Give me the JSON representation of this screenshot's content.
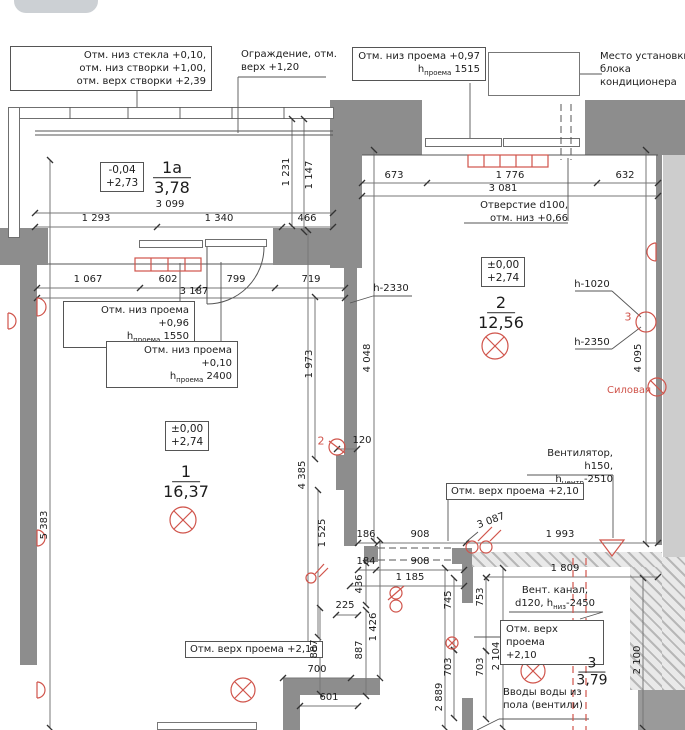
{
  "colors": {
    "wall_gray": "#8d8d8d",
    "outer_gray": "#cdcdcd",
    "accent_red": "#d0544b",
    "line_dark": "#333333"
  },
  "rooms": {
    "balcony": {
      "num": "1а",
      "area": "3,78",
      "level1": "-0,04",
      "level2": "+2,73"
    },
    "room1": {
      "num": "1",
      "area": "16,37",
      "level1": "±0,00",
      "level2": "+2,74"
    },
    "room2": {
      "num": "2",
      "area": "12,56",
      "level1": "±0,00",
      "level2": "+2,74"
    },
    "room3": {
      "num": "3",
      "area": "3,79"
    }
  },
  "notes": {
    "glass": {
      "l1": "Отм. низ стекла +0,10,",
      "l2": "отм. низ створки +1,00,",
      "l3": "отм. верх створки +2,39"
    },
    "fence": {
      "l1": "Ограждение, отм.",
      "l2": "верх +1,20"
    },
    "opening097": {
      "l1": "Отм. низ проема +0,97",
      "pre": "h",
      "sub": "проема",
      "post": " 1515"
    },
    "ac": {
      "l1": "Место установки",
      "l2": "блока кондиционера"
    },
    "hole": {
      "l1": "Отверстие d100,",
      "l2": "отм. низ +0,66"
    },
    "opening096": {
      "l1": "Отм. низ проема +0,96",
      "pre": "h",
      "sub": "проема",
      "post": " 1550"
    },
    "opening010": {
      "l1": "Отм. низ проема +0,10",
      "pre": "h",
      "sub": "проема",
      "post": " 2400"
    },
    "h2330": "h-2330",
    "h1020": "h-1020",
    "h2350": "h-2350",
    "silovaya": "Силовая",
    "fan": {
      "l1": "Вентилятор,",
      "pre": "h150, h",
      "sub": "центр",
      "post": "-2510"
    },
    "top210mid": "Отм. верх проема +2,10",
    "top210left": "Отм. верх проема +2,10",
    "top210room3": {
      "l1": "Отм. верх проема",
      "l2": "+2,10"
    },
    "vent": {
      "l1": "Вент. канал,",
      "pre": "d120, h",
      "sub": "низ",
      "post": "-2450"
    },
    "water": {
      "l1": "Вводы воды из",
      "l2": "пола (вентили)"
    },
    "marker2": "2",
    "marker3": "3"
  },
  "dims": {
    "d3099": "3 099",
    "d1293": "1 293",
    "d1340": "1 340",
    "d466": "466",
    "d1231": "1 231",
    "d1147": "1 147",
    "d1067": "1 067",
    "d602": "602",
    "d799": "799",
    "d719": "719",
    "d3187": "3 187",
    "d673": "673",
    "d1776": "1 776",
    "d632": "632",
    "d3081": "3 081",
    "d1973": "1 973",
    "d4048": "4 048",
    "d4095": "4 095",
    "d4385": "4 385",
    "d1525": "1 525",
    "d5383": "5 383",
    "d120": "120",
    "d186": "186",
    "d908a": "908",
    "d184": "184",
    "d908b": "908",
    "d1185": "1 185",
    "d3087": "3 087",
    "d1993": "1 993",
    "d1809": "1 809",
    "d225": "225",
    "d436": "436",
    "d887a": "887",
    "d887b": "887",
    "d1426": "1 426",
    "d745": "745",
    "d753": "753",
    "d703a": "703",
    "d703b": "703",
    "d2104": "2 104",
    "d2889": "2 889",
    "d2100": "2 100",
    "d700": "700",
    "d601": "601"
  }
}
